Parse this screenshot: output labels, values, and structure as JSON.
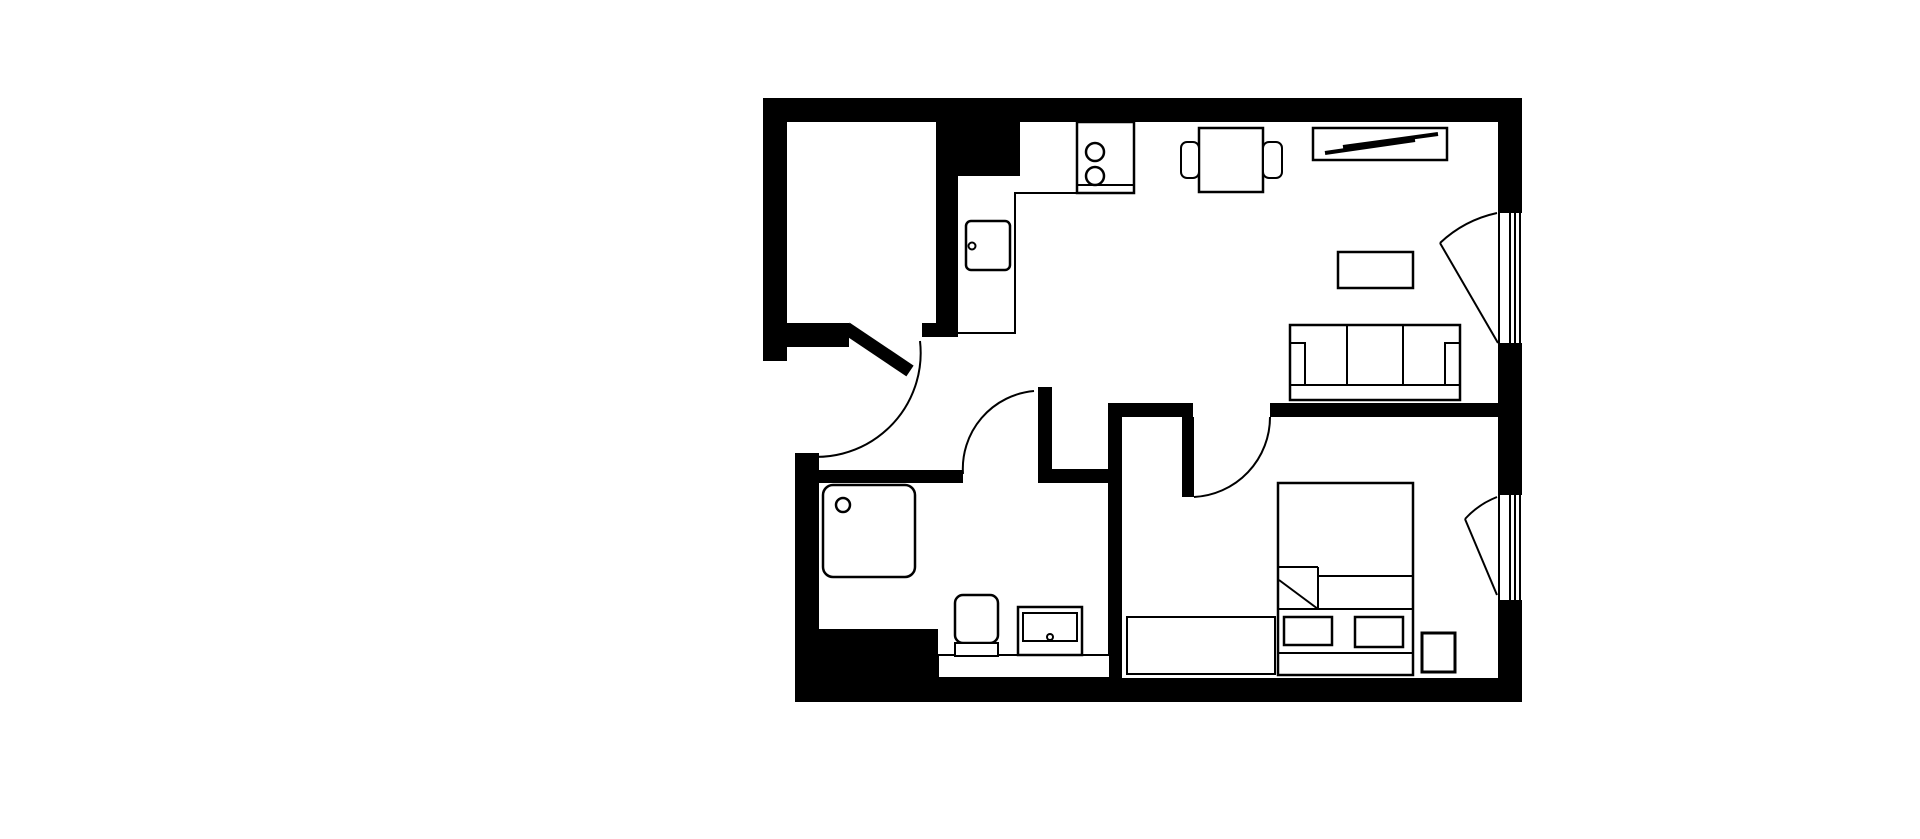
{
  "meta": {
    "description": "Black and white architectural floor plan of a one-bedroom apartment",
    "canvas": {
      "width": 1920,
      "height": 839,
      "background": "#ffffff",
      "ink": "#000000"
    }
  },
  "plan": {
    "elements": [
      {
        "name": "exterior-wall-top",
        "type": "rect",
        "x": 763,
        "y": 98,
        "w": 759,
        "h": 24,
        "fill": "#000000"
      },
      {
        "name": "exterior-wall-left-closet",
        "type": "rect",
        "x": 763,
        "y": 98,
        "w": 24,
        "h": 263,
        "fill": "#000000"
      },
      {
        "name": "closet-bottom-wall",
        "type": "rect",
        "x": 787,
        "y": 323,
        "w": 62,
        "h": 24,
        "fill": "#000000"
      },
      {
        "name": "closet-door-jamb-stub",
        "type": "rect",
        "x": 922,
        "y": 323,
        "w": 36,
        "h": 14,
        "fill": "#000000"
      },
      {
        "name": "closet-right-wall",
        "type": "rect",
        "x": 936,
        "y": 122,
        "w": 22,
        "h": 215,
        "fill": "#000000"
      },
      {
        "name": "kitchen-wall-block",
        "type": "rect",
        "x": 936,
        "y": 122,
        "w": 84,
        "h": 54,
        "fill": "#000000"
      },
      {
        "name": "exterior-wall-right-upper",
        "type": "rect",
        "x": 1498,
        "y": 98,
        "w": 24,
        "h": 115,
        "fill": "#000000"
      },
      {
        "name": "exterior-wall-right-middle",
        "type": "rect",
        "x": 1498,
        "y": 343,
        "w": 24,
        "h": 152,
        "fill": "#000000"
      },
      {
        "name": "exterior-wall-right-lower",
        "type": "rect",
        "x": 1498,
        "y": 600,
        "w": 24,
        "h": 102,
        "fill": "#000000"
      },
      {
        "name": "exterior-wall-bottom",
        "type": "rect",
        "x": 795,
        "y": 678,
        "w": 727,
        "h": 24,
        "fill": "#000000"
      },
      {
        "name": "exterior-wall-left-bath",
        "type": "rect",
        "x": 795,
        "y": 453,
        "w": 24,
        "h": 249,
        "fill": "#000000"
      },
      {
        "name": "bathroom-corner-block",
        "type": "rect",
        "x": 795,
        "y": 629,
        "w": 143,
        "h": 60,
        "fill": "#000000"
      },
      {
        "name": "bathroom-top-wall",
        "type": "rect",
        "x": 819,
        "y": 470,
        "w": 144,
        "h": 13,
        "fill": "#000000"
      },
      {
        "name": "hall-wall-vertical",
        "type": "rect",
        "x": 1038,
        "y": 387,
        "w": 14,
        "h": 96,
        "fill": "#000000"
      },
      {
        "name": "hall-wall-horizontal",
        "type": "rect",
        "x": 1038,
        "y": 469,
        "w": 84,
        "h": 14,
        "fill": "#000000"
      },
      {
        "name": "bedroom-left-wall",
        "type": "rect",
        "x": 1108,
        "y": 403,
        "w": 14,
        "h": 275,
        "fill": "#000000"
      },
      {
        "name": "hall-top-wall",
        "type": "rect",
        "x": 1108,
        "y": 403,
        "w": 85,
        "h": 14,
        "fill": "#000000"
      },
      {
        "name": "bedroom-top-wall",
        "type": "rect",
        "x": 1270,
        "y": 403,
        "w": 228,
        "h": 14,
        "fill": "#000000"
      },
      {
        "name": "bedroom-door-leaf",
        "type": "rect",
        "x": 1182,
        "y": 417,
        "w": 12,
        "h": 80,
        "fill": "#000000"
      },
      {
        "name": "entry-door-leaf",
        "type": "line",
        "x1": 846,
        "y1": 328,
        "x2": 910,
        "y2": 371,
        "sw": 13
      },
      {
        "name": "entry-door-swing-arc",
        "type": "path",
        "d": "M 920 341 A 104 104 0 0 1 797 455",
        "sw": 2
      },
      {
        "name": "bathroom-door-swing-arc",
        "type": "path",
        "d": "M 963 474 A 78 78 0 0 1 1034 391",
        "sw": 2
      },
      {
        "name": "bedroom-door-swing-arc",
        "type": "path",
        "d": "M 1194 497 A 80 80 0 0 0 1270 417",
        "sw": 2
      },
      {
        "name": "living-window-glass-line-1",
        "type": "line",
        "x1": 1499,
        "y1": 213,
        "x2": 1499,
        "y2": 343,
        "sw": 2
      },
      {
        "name": "living-window-glass-line-2",
        "type": "line",
        "x1": 1510,
        "y1": 213,
        "x2": 1510,
        "y2": 343,
        "sw": 2
      },
      {
        "name": "living-window-glass-line-3",
        "type": "line",
        "x1": 1515,
        "y1": 213,
        "x2": 1515,
        "y2": 343,
        "sw": 2
      },
      {
        "name": "living-window-glass-line-4",
        "type": "line",
        "x1": 1520,
        "y1": 213,
        "x2": 1520,
        "y2": 343,
        "sw": 2
      },
      {
        "name": "living-window-casement-leaf",
        "type": "line",
        "x1": 1498,
        "y1": 343,
        "x2": 1440,
        "y2": 243,
        "sw": 2
      },
      {
        "name": "living-window-swing-arc",
        "type": "path",
        "d": "M 1440 243 A 120 120 0 0 1 1497 213",
        "sw": 2
      },
      {
        "name": "bedroom-window-glass-line-1",
        "type": "line",
        "x1": 1499,
        "y1": 495,
        "x2": 1499,
        "y2": 600,
        "sw": 2
      },
      {
        "name": "bedroom-window-glass-line-2",
        "type": "line",
        "x1": 1510,
        "y1": 495,
        "x2": 1510,
        "y2": 600,
        "sw": 2
      },
      {
        "name": "bedroom-window-glass-line-3",
        "type": "line",
        "x1": 1515,
        "y1": 495,
        "x2": 1515,
        "y2": 600,
        "sw": 2
      },
      {
        "name": "bedroom-window-glass-line-4",
        "type": "line",
        "x1": 1520,
        "y1": 495,
        "x2": 1520,
        "y2": 600,
        "sw": 2
      },
      {
        "name": "bedroom-window-casement-leaf",
        "type": "line",
        "x1": 1497,
        "y1": 595,
        "x2": 1465,
        "y2": 519,
        "sw": 2
      },
      {
        "name": "bedroom-window-swing-arc",
        "type": "path",
        "d": "M 1465 519 A 85 85 0 0 1 1497 497",
        "sw": 2
      },
      {
        "name": "kitchen-counter-edge",
        "type": "path",
        "d": "M 952 333 L 1015 333 L 1015 193 L 1077 193",
        "sw": 2
      },
      {
        "name": "kitchen-stove",
        "type": "rect",
        "x": 1077,
        "y": 122,
        "w": 57,
        "h": 71,
        "fill": "#ffffff",
        "sw": 2.5
      },
      {
        "name": "kitchen-stove-front-line",
        "type": "line",
        "x1": 1077,
        "y1": 185,
        "x2": 1134,
        "y2": 185,
        "sw": 2
      },
      {
        "name": "stove-burner-top",
        "type": "circle",
        "cx": 1095,
        "cy": 152,
        "r": 9,
        "fill": "#ffffff",
        "sw": 2.5
      },
      {
        "name": "stove-burner-bottom",
        "type": "circle",
        "cx": 1095,
        "cy": 176,
        "r": 9,
        "fill": "#ffffff",
        "sw": 2.5
      },
      {
        "name": "kitchen-sink",
        "type": "rect",
        "x": 966,
        "y": 221,
        "w": 44,
        "h": 49,
        "rx": 5,
        "fill": "#ffffff",
        "sw": 2.5
      },
      {
        "name": "kitchen-sink-faucet-dot",
        "type": "circle",
        "cx": 972,
        "cy": 246,
        "r": 3.5,
        "fill": "#ffffff",
        "sw": 2
      },
      {
        "name": "dining-table",
        "type": "rect",
        "x": 1199,
        "y": 128,
        "w": 64,
        "h": 64,
        "fill": "#ffffff",
        "sw": 2.5
      },
      {
        "name": "dining-chair-left",
        "type": "rect",
        "x": 1181,
        "y": 142,
        "w": 18,
        "h": 36,
        "rx": 6,
        "fill": "#ffffff",
        "sw": 2
      },
      {
        "name": "dining-chair-right",
        "type": "rect",
        "x": 1263,
        "y": 142,
        "w": 19,
        "h": 36,
        "rx": 6,
        "fill": "#ffffff",
        "sw": 2
      },
      {
        "name": "sideboard",
        "type": "rect",
        "x": 1313,
        "y": 128,
        "w": 134,
        "h": 32,
        "fill": "#ffffff",
        "sw": 2.5
      },
      {
        "name": "sideboard-slat-1",
        "type": "line",
        "x1": 1325,
        "y1": 153,
        "x2": 1415,
        "y2": 140,
        "sw": 4
      },
      {
        "name": "sideboard-slat-2",
        "type": "line",
        "x1": 1343,
        "y1": 147,
        "x2": 1438,
        "y2": 134,
        "sw": 4
      },
      {
        "name": "coffee-table",
        "type": "rect",
        "x": 1338,
        "y": 252,
        "w": 75,
        "h": 36,
        "fill": "#ffffff",
        "sw": 2.5
      },
      {
        "name": "sofa-body",
        "type": "rect",
        "x": 1290,
        "y": 325,
        "w": 170,
        "h": 75,
        "fill": "#ffffff",
        "sw": 2.5
      },
      {
        "name": "sofa-seat-front-line",
        "type": "line",
        "x1": 1290,
        "y1": 385,
        "x2": 1460,
        "y2": 385,
        "sw": 2
      },
      {
        "name": "sofa-cushion-divider-1",
        "type": "line",
        "x1": 1347,
        "y1": 325,
        "x2": 1347,
        "y2": 385,
        "sw": 2
      },
      {
        "name": "sofa-cushion-divider-2",
        "type": "line",
        "x1": 1403,
        "y1": 325,
        "x2": 1403,
        "y2": 385,
        "sw": 2
      },
      {
        "name": "sofa-armrest-left",
        "type": "path",
        "d": "M 1290 343 L 1305 343 L 1305 385",
        "sw": 2
      },
      {
        "name": "sofa-armrest-right",
        "type": "path",
        "d": "M 1460 343 L 1445 343 L 1445 385",
        "sw": 2
      },
      {
        "name": "shower-tray",
        "type": "rect",
        "x": 823,
        "y": 485,
        "w": 92,
        "h": 92,
        "rx": 10,
        "fill": "#ffffff",
        "sw": 2.5
      },
      {
        "name": "shower-drain",
        "type": "circle",
        "cx": 843,
        "cy": 505,
        "r": 7,
        "fill": "#ffffff",
        "sw": 2.5
      },
      {
        "name": "bathroom-vanity-ledge",
        "type": "rect",
        "x": 938,
        "y": 655,
        "w": 172,
        "h": 23,
        "fill": "#ffffff",
        "sw": 2
      },
      {
        "name": "toilet-bowl",
        "type": "rect",
        "x": 955,
        "y": 595,
        "w": 43,
        "h": 48,
        "rx": 8,
        "fill": "#ffffff",
        "sw": 2.5
      },
      {
        "name": "toilet-tank",
        "type": "rect",
        "x": 955,
        "y": 643,
        "w": 43,
        "h": 13,
        "fill": "#ffffff",
        "sw": 2
      },
      {
        "name": "bathroom-sink-cabinet",
        "type": "rect",
        "x": 1018,
        "y": 607,
        "w": 64,
        "h": 48,
        "fill": "#ffffff",
        "sw": 2.5
      },
      {
        "name": "bathroom-sink-basin",
        "type": "rect",
        "x": 1023,
        "y": 613,
        "w": 54,
        "h": 28,
        "fill": "#ffffff",
        "sw": 2
      },
      {
        "name": "bathroom-sink-drain-dot",
        "type": "circle",
        "cx": 1050,
        "cy": 637,
        "r": 3,
        "fill": "#ffffff",
        "sw": 2
      },
      {
        "name": "bed",
        "type": "rect",
        "x": 1278,
        "y": 483,
        "w": 135,
        "h": 192,
        "fill": "#ffffff",
        "sw": 2.5
      },
      {
        "name": "bed-blanket-edge-line",
        "type": "line",
        "x1": 1318,
        "y1": 576,
        "x2": 1413,
        "y2": 576,
        "sw": 2
      },
      {
        "name": "bed-fold-top-line",
        "type": "line",
        "x1": 1278,
        "y1": 567,
        "x2": 1318,
        "y2": 567,
        "sw": 2
      },
      {
        "name": "bed-fold-side-line",
        "type": "line",
        "x1": 1318,
        "y1": 567,
        "x2": 1318,
        "y2": 609,
        "sw": 2
      },
      {
        "name": "bed-fold-diagonal",
        "type": "line",
        "x1": 1279,
        "y1": 580,
        "x2": 1318,
        "y2": 609,
        "sw": 2
      },
      {
        "name": "bed-sheet-line",
        "type": "line",
        "x1": 1278,
        "y1": 609,
        "x2": 1413,
        "y2": 609,
        "sw": 2
      },
      {
        "name": "bed-pillow-left",
        "type": "rect",
        "x": 1284,
        "y": 617,
        "w": 48,
        "h": 28,
        "fill": "#ffffff",
        "sw": 2.5
      },
      {
        "name": "bed-pillow-right",
        "type": "rect",
        "x": 1355,
        "y": 617,
        "w": 48,
        "h": 30,
        "fill": "#ffffff",
        "sw": 2.5
      },
      {
        "name": "bed-headboard-line",
        "type": "line",
        "x1": 1278,
        "y1": 653,
        "x2": 1413,
        "y2": 653,
        "sw": 2
      },
      {
        "name": "bedroom-bench",
        "type": "rect",
        "x": 1127,
        "y": 617,
        "w": 148,
        "h": 57,
        "fill": "#ffffff",
        "sw": 2
      },
      {
        "name": "bedroom-nightstand",
        "type": "rect",
        "x": 1422,
        "y": 633,
        "w": 33,
        "h": 39,
        "fill": "#ffffff",
        "sw": 3
      }
    ]
  }
}
